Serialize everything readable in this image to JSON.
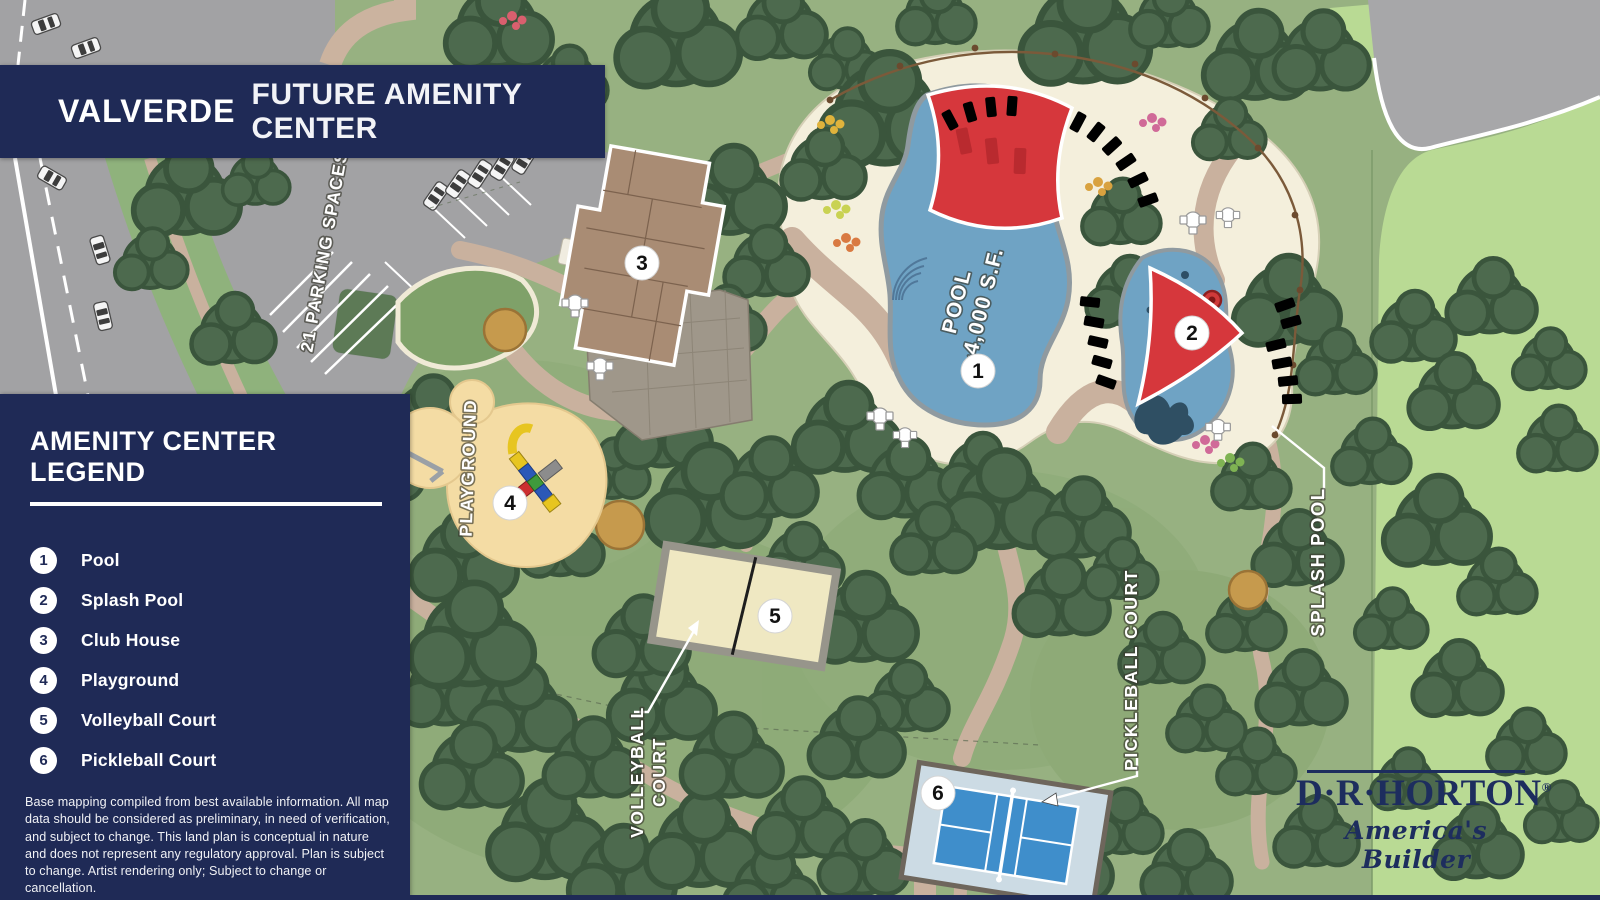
{
  "banner": {
    "community": "VALVERDE",
    "subtitle": "FUTURE AMENITY CENTER"
  },
  "legend": {
    "title": "AMENITY CENTER LEGEND",
    "items": [
      {
        "number": "1",
        "label": "Pool"
      },
      {
        "number": "2",
        "label": "Splash Pool"
      },
      {
        "number": "3",
        "label": "Club House"
      },
      {
        "number": "4",
        "label": "Playground"
      },
      {
        "number": "5",
        "label": "Volleyball Court"
      },
      {
        "number": "6",
        "label": "Pickleball Court"
      }
    ]
  },
  "disclaimer": "Base mapping compiled from best available information. All map data should be considered as preliminary, in need of verification, and subject to change. This land plan is conceptual in nature and does not represent any regulatory approval. Plan is subject to change. Artist rendering only; Subject to change or cancellation.",
  "map": {
    "labels": {
      "parking": "21 PARKING SPACES",
      "playground": "PLAYGROUND",
      "pool_line1": "POOL",
      "pool_line2": "~4,000 S.F.",
      "volleyball_line1": "VOLLEYBALL",
      "volleyball_line2": "COURT",
      "pickleball": "PICKLEBALL COURT",
      "splash_pool": "SPLASH POOL"
    },
    "markers": [
      {
        "number": "1",
        "feature": "Pool"
      },
      {
        "number": "2",
        "feature": "Splash Pool"
      },
      {
        "number": "3",
        "feature": "Club House"
      },
      {
        "number": "4",
        "feature": "Playground"
      },
      {
        "number": "5",
        "feature": "Volleyball Court"
      },
      {
        "number": "6",
        "feature": "Pickleball Court"
      }
    ]
  },
  "logo": {
    "name": "D·R·HORTON",
    "registered": "®",
    "tagline": "America's Builder"
  },
  "colors": {
    "navy": "#1f2a56",
    "park_green": "#97b181",
    "light_green": "#b9da94",
    "tree_green": "#4d6a4e",
    "road_gray": "#a2a2a4",
    "path_tan": "#c9b19e",
    "deck_cream": "#f4efdc",
    "pool_blue": "#6fa3c4",
    "sail_red": "#d6373c",
    "volleyball_sand": "#efe8c2",
    "pickleball_blue": "#3f8ecb",
    "playground_sand": "#f4dca4"
  }
}
